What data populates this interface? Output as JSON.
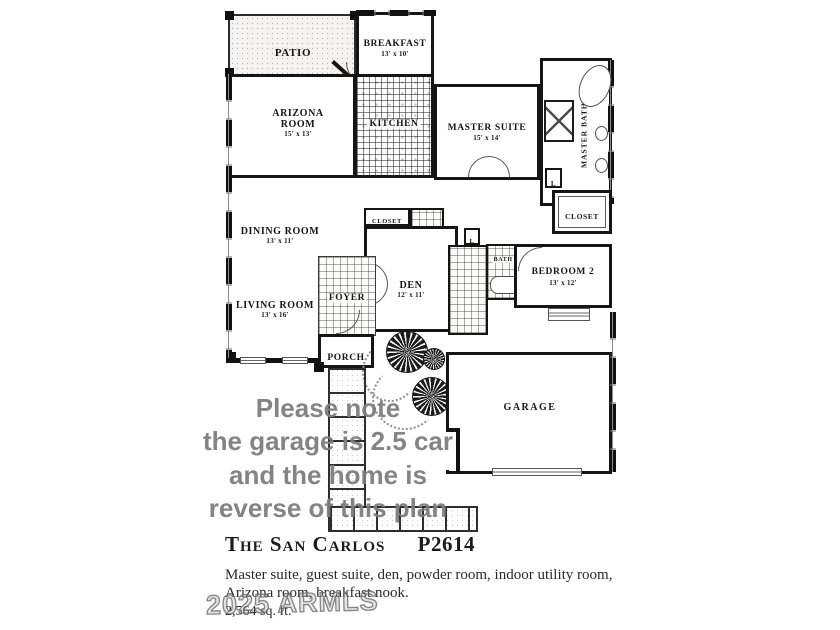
{
  "colors": {
    "walls": "#151515",
    "watermark_gray": "#7d7d7d",
    "ink": "#161616"
  },
  "rooms": {
    "patio": {
      "label": "PATIO"
    },
    "breakfast": {
      "label": "BREAKFAST",
      "dims": "13' x 10'"
    },
    "arizona_room": {
      "label": "ARIZONA\nROOM",
      "dims": "15' x 13'"
    },
    "kitchen": {
      "label": "KITCHEN"
    },
    "master_suite": {
      "label": "MASTER SUITE",
      "dims": "15' x 14'"
    },
    "master_bath": {
      "label": "MASTER BATH"
    },
    "master_closet": {
      "label": "CLOSET"
    },
    "linen1": {
      "label": "L"
    },
    "linen2": {
      "label": "L"
    },
    "dining_room": {
      "label": "DINING ROOM",
      "dims": "13' x 11'"
    },
    "den_closet": {
      "label": "CLOSET"
    },
    "powder": {
      "label": "PWDR"
    },
    "den": {
      "label": "DEN",
      "dims": "12' x 11'"
    },
    "living_room": {
      "label": "LIVING ROOM",
      "dims": "13' x 16'"
    },
    "foyer": {
      "label": "FOYER"
    },
    "bedroom2": {
      "label": "BEDROOM 2",
      "dims": "13' x 12'"
    },
    "bath2": {
      "label": "BATH 2"
    },
    "porch": {
      "label": "PORCH"
    },
    "garage": {
      "label": "GARAGE"
    }
  },
  "watermark_note": {
    "lines": [
      "Please note",
      "the garage is 2.5 car",
      "and the home is",
      "reverse of this plan"
    ]
  },
  "armls_watermark": "2025 ARMLS",
  "footer": {
    "title": "The San Carlos",
    "plan_code": "P2614",
    "description_line1": "Master suite, guest suite, den, powder room, indoor utility room,",
    "description_line2": "Arizona room, breakfast nook.",
    "sqft": "2,564 sq. ft."
  }
}
